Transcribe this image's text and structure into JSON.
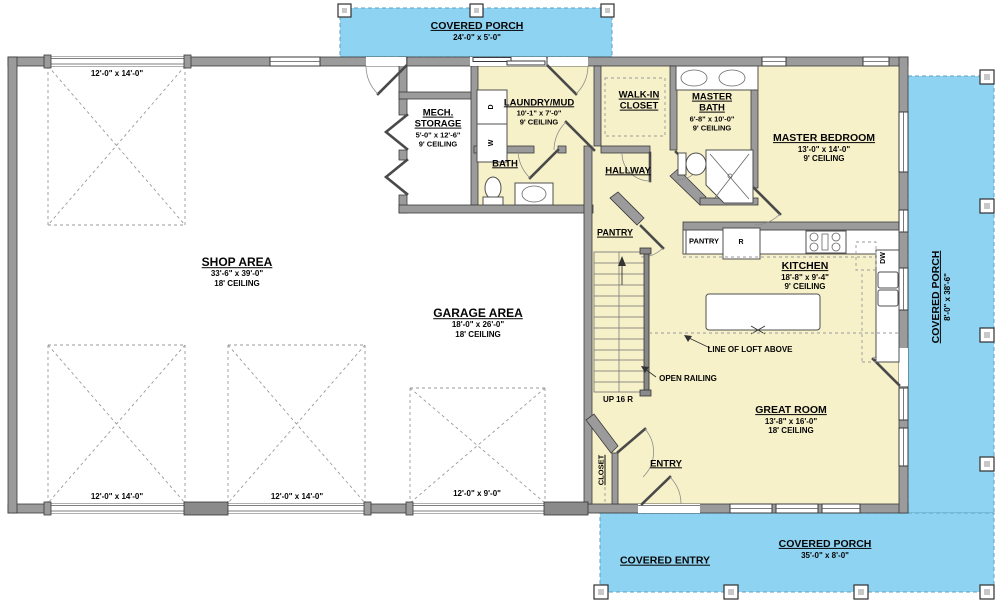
{
  "colors": {
    "porch_blue": "#8ed3f2",
    "living_yellow": "#f7f1ca",
    "wall_gray": "#9b9b9b"
  },
  "porches": {
    "top": {
      "name": "COVERED PORCH",
      "dims": "24'-0\" x 5'-0\""
    },
    "right": {
      "name": "COVERED PORCH",
      "dims": "8'-0\" x 38'-6\""
    },
    "bottom": {
      "name": "COVERED PORCH",
      "dims": "35'-0\" x 8'-0\""
    },
    "entry": {
      "name": "COVERED ENTRY"
    }
  },
  "rooms": {
    "shop": {
      "name": "SHOP AREA",
      "dims": "33'-6\" x 39'-0\"",
      "ceiling": "18' CEILING"
    },
    "garage": {
      "name": "GARAGE AREA",
      "dims": "18'-0\" x 26'-0\"",
      "ceiling": "18' CEILING"
    },
    "great_room": {
      "name": "GREAT ROOM",
      "dims": "13'-8\" x 16'-0\"",
      "ceiling": "18' CEILING"
    },
    "kitchen": {
      "name": "KITCHEN",
      "dims": "18'-8\" x 9'-4\"",
      "ceiling": "9' CEILING"
    },
    "master_bedroom": {
      "name": "MASTER BEDROOM",
      "dims": "13'-0\" x 14'-0\"",
      "ceiling": "9' CEILING"
    },
    "master_bath": {
      "name": "MASTER BATH",
      "dims": "6'-8\" x 10'-0\"",
      "ceiling": "9' CEILING"
    },
    "walk_in_closet": {
      "name": "WALK-IN CLOSET"
    },
    "laundry": {
      "name": "LAUNDRY/MUD",
      "dims": "10'-1\" x 7'-0\"",
      "ceiling": "9' CEILING"
    },
    "mech": {
      "name": "MECH. STORAGE",
      "dims": "5'-0\" x 12'-6\"",
      "ceiling": "9' CEILING"
    },
    "bath": {
      "name": "BATH"
    },
    "hallway": {
      "name": "HALLWAY"
    },
    "pantry_hall": {
      "name": "PANTRY"
    },
    "pantry_kitchen": {
      "name": "PANTRY"
    },
    "entry": {
      "name": "ENTRY"
    },
    "closet": {
      "name": "CLOSET"
    }
  },
  "annotations": {
    "loft_line": "LINE OF LOFT ABOVE",
    "open_railing": "OPEN RAILING",
    "stairs": "UP 16 R"
  },
  "openings": {
    "garage_door_large": "12'-0\" x 14'-0\"",
    "garage_door_small": "12'-0\" x 9'-0\""
  },
  "appliances": {
    "dryer": "D",
    "washer": "W",
    "refrigerator": "R",
    "dishwasher": "DW"
  }
}
